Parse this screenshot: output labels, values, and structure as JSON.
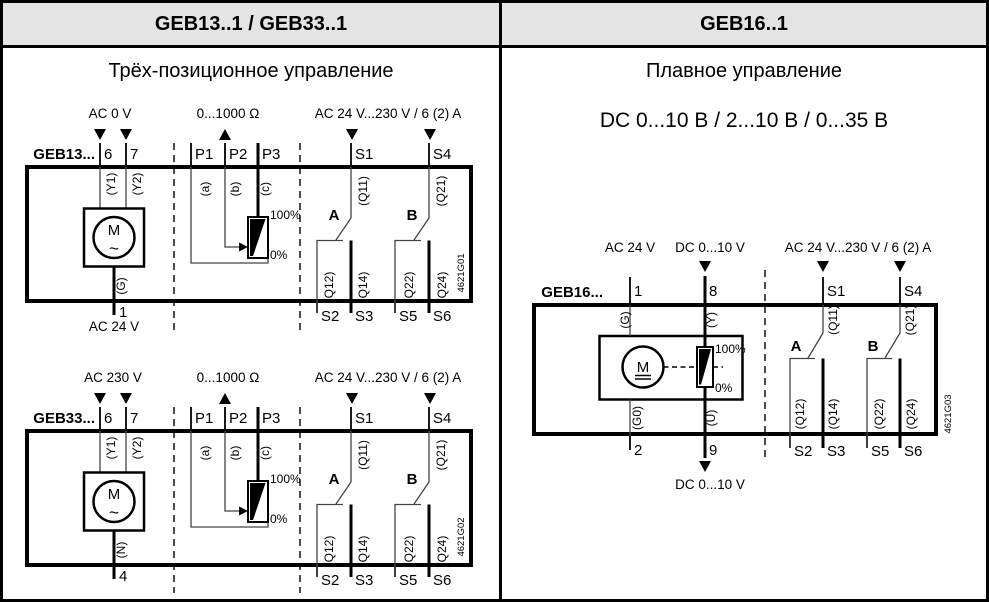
{
  "header": {
    "left_title": "GEB13..1 / GEB33..1",
    "right_title": "GEB16..1"
  },
  "left_panel": {
    "subtitle": "Трёх-позиционное управление",
    "geb13": {
      "model": "GEB13...",
      "ref_code": "4621G01",
      "labels": {
        "supply_top": "AC 0 V",
        "pot_range": "0...1000 Ω",
        "relay": "AC 24 V...230 V / 6 (2) A",
        "supply_bottom": "AC 24 V",
        "pot_max": "100%",
        "pot_min": "0%",
        "switch_a": "A",
        "switch_b": "B",
        "motor": "M",
        "motor_current": "~"
      },
      "terminals": {
        "t6": "6",
        "t7": "7",
        "t1": "1",
        "p1": "P1",
        "p2": "P2",
        "p3": "P3",
        "s1": "S1",
        "s2": "S2",
        "s3": "S3",
        "s4": "S4",
        "s5": "S5",
        "s6": "S6"
      },
      "wires": {
        "y1": "(Y1)",
        "y2": "(Y2)",
        "g": "(G)",
        "a": "(a)",
        "b": "(b)",
        "c": "(c)",
        "q11": "(Q11)",
        "q12": "(Q12)",
        "q14": "(Q14)",
        "q21": "(Q21)",
        "q22": "(Q22)",
        "q24": "(Q24)"
      }
    },
    "geb33": {
      "model": "GEB33...",
      "ref_code": "4621G02",
      "labels": {
        "supply_top": "AC 230 V",
        "pot_range": "0...1000 Ω",
        "relay": "AC 24 V...230 V / 6 (2) A",
        "pot_max": "100%",
        "pot_min": "0%",
        "switch_a": "A",
        "switch_b": "B",
        "motor": "M",
        "motor_current": "~"
      },
      "terminals": {
        "t6": "6",
        "t7": "7",
        "t4": "4",
        "p1": "P1",
        "p2": "P2",
        "p3": "P3",
        "s1": "S1",
        "s2": "S2",
        "s3": "S3",
        "s4": "S4",
        "s5": "S5",
        "s6": "S6"
      },
      "wires": {
        "y1": "(Y1)",
        "y2": "(Y2)",
        "n": "(N)",
        "a": "(a)",
        "b": "(b)",
        "c": "(c)",
        "q11": "(Q11)",
        "q12": "(Q12)",
        "q14": "(Q14)",
        "q21": "(Q21)",
        "q22": "(Q22)",
        "q24": "(Q24)"
      }
    }
  },
  "right_panel": {
    "subtitle": "Плавное управление",
    "signal_range": "DC 0...10 В / 2...10 В / 0...35 В",
    "geb16": {
      "model": "GEB16...",
      "ref_code": "4621G03",
      "labels": {
        "supply_top": "AC 24 V",
        "input_top": "DC 0...10 V",
        "relay": "AC 24 V...230 V / 6 (2) A",
        "output_bottom": "DC 0...10 V",
        "pot_max": "100%",
        "pot_min": "0%",
        "switch_a": "A",
        "switch_b": "B",
        "motor": "M"
      },
      "terminals": {
        "t1": "1",
        "t2": "2",
        "t8": "8",
        "t9": "9",
        "s1": "S1",
        "s2": "S2",
        "s3": "S3",
        "s4": "S4",
        "s5": "S5",
        "s6": "S6"
      },
      "wires": {
        "g": "(G)",
        "g0": "(G0)",
        "y": "(Y)",
        "u": "(U)",
        "q11": "(Q11)",
        "q12": "(Q12)",
        "q14": "(Q14)",
        "q21": "(Q21)",
        "q22": "(Q22)",
        "q24": "(Q24)"
      }
    }
  }
}
